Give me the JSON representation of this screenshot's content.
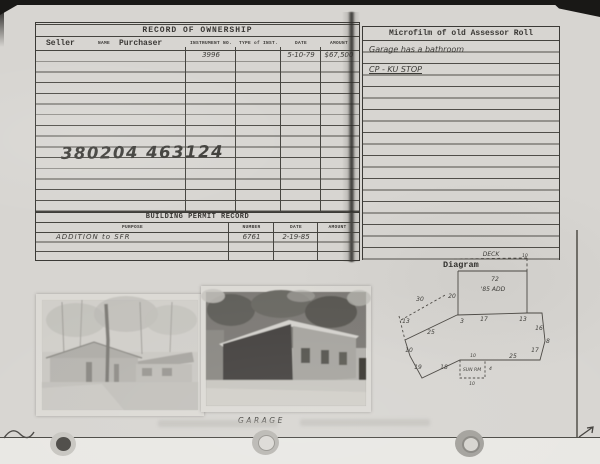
{
  "ownership": {
    "title": "RECORD OF OWNERSHIP",
    "header": {
      "seller": "Seller",
      "name": "NAME",
      "purchaser": "Purchaser",
      "instrument": "INSTRUMENT NO.",
      "type": "TYPE of INST.",
      "date": "DATE",
      "amount": "AMOUNT"
    },
    "entry": {
      "instrument_no": "3996",
      "date": "5-10-79",
      "amount": "$67,500"
    },
    "parcel_number": "380204 463124"
  },
  "microfilm": {
    "title": "Microfilm of old Assessor Roll",
    "note1": "Garage has a bathroom",
    "note2": "CP - KU STOP"
  },
  "building_permit": {
    "title": "BUILDING PERMIT RECORD",
    "header": {
      "purpose": "PURPOSE",
      "number": "NUMBER",
      "date": "DATE",
      "amount": "AMOUNT"
    },
    "entry": {
      "purpose": "ADDITION to SFR",
      "number": "6761",
      "date": "2-19-85",
      "amount": ""
    }
  },
  "photos": {
    "right_caption": "GARAGE"
  },
  "diagram": {
    "label": "Diagram",
    "dims": {
      "deck": "DECK",
      "deck_depth": "10",
      "top_width": "72",
      "addition": "'85 ADD",
      "add_left": "20",
      "dash_len": "30",
      "left_dash": "13",
      "seg_a": "3",
      "seg_b": "17",
      "seg_c": "13",
      "diag_ul": "25",
      "left_v": "10",
      "diag_ll": "19",
      "bottom_l": "18",
      "porch": "SUN RM",
      "porch_w_top": "10",
      "porch_d": "4",
      "porch_w_bot": "10",
      "bottom_r": "25",
      "diag_lr": "17",
      "corner": "8",
      "right_v": "16"
    }
  },
  "colors": {
    "paper": "#d7d5d1",
    "ink": "#3a3835",
    "handwriting": "#3c3b37",
    "scan_edge": "#191816"
  }
}
